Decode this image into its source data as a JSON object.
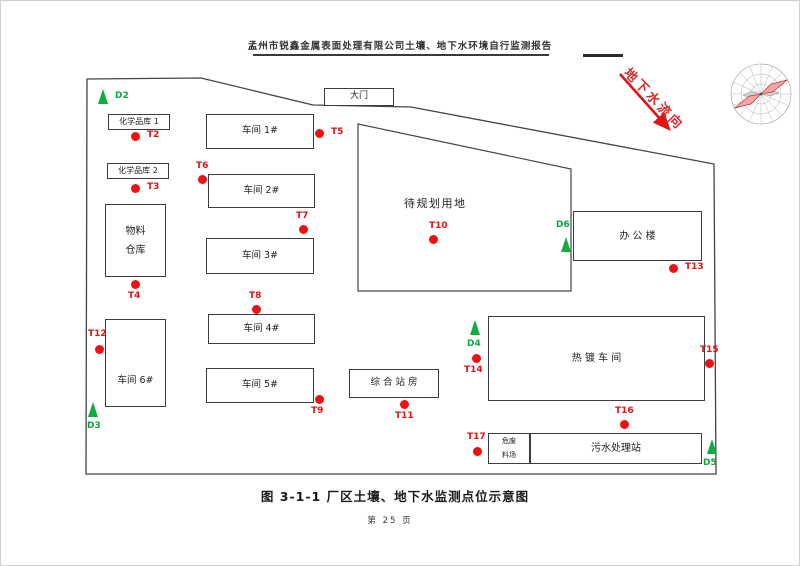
{
  "header": {
    "title": "孟州市锐鑫金属表面处理有限公司土壤、地下水环境自行监测报告"
  },
  "figure": {
    "caption": "图 3-1-1  厂区土壤、地下水监测点位示意图",
    "page_number": "第 25 页",
    "flow_arrow_label": "地下水流向"
  },
  "colors": {
    "point_red": "#ee1111",
    "label_red": "#e11212",
    "triangle_green": "#12ad3f",
    "label_green": "#0ca53e",
    "rose_pink": "#f2a6a6",
    "line_dark": "#3c3c3c"
  },
  "site": {
    "boundary_points": "86,78 200,77 312,104 410,106 713,163 715,473 85,473",
    "planned_area_points": "357,123 570,168 570,290 357,290",
    "planned_area_label": "待规划用地"
  },
  "buildings": [
    {
      "id": "chem-store-1",
      "label": "化学品库 1",
      "x": 107,
      "y": 113,
      "w": 62,
      "h": 16,
      "fs": 8
    },
    {
      "id": "chem-store-2",
      "label": "化学品库 2",
      "x": 106,
      "y": 162,
      "w": 62,
      "h": 16,
      "fs": 8
    },
    {
      "id": "material-warehouse",
      "label": "物料\n仓库",
      "x": 104,
      "y": 203,
      "w": 61,
      "h": 73,
      "fs": 10
    },
    {
      "id": "workshop-6",
      "label": "车间 6#",
      "x": 104,
      "y": 318,
      "w": 61,
      "h": 88,
      "fs": 9.5,
      "shift": 18
    },
    {
      "id": "workshop-1",
      "label": "车间 1#",
      "x": 205,
      "y": 113,
      "w": 108,
      "h": 35,
      "fs": 9.5
    },
    {
      "id": "workshop-2",
      "label": "车间 2#",
      "x": 207,
      "y": 173,
      "w": 107,
      "h": 34,
      "fs": 9.5
    },
    {
      "id": "workshop-3",
      "label": "车间 3#",
      "x": 205,
      "y": 237,
      "w": 108,
      "h": 36,
      "fs": 9.5
    },
    {
      "id": "workshop-4",
      "label": "车间 4#",
      "x": 207,
      "y": 313,
      "w": 107,
      "h": 30,
      "fs": 9.5
    },
    {
      "id": "workshop-5",
      "label": "车间 5#",
      "x": 205,
      "y": 367,
      "w": 108,
      "h": 35,
      "fs": 9.5
    },
    {
      "id": "main-gate",
      "label": "大门",
      "x": 323,
      "y": 87,
      "w": 70,
      "h": 18,
      "fs": 9
    },
    {
      "id": "composite-station",
      "label": "综 合 站 房",
      "x": 348,
      "y": 368,
      "w": 90,
      "h": 29,
      "fs": 9.5
    },
    {
      "id": "office-building",
      "label": "办 公 楼",
      "x": 572,
      "y": 210,
      "w": 129,
      "h": 50,
      "fs": 10
    },
    {
      "id": "galvanizing-workshop",
      "label": "热 镀 车 间",
      "x": 487,
      "y": 315,
      "w": 217,
      "h": 85,
      "fs": 10
    },
    {
      "id": "hazardous-waste-yard",
      "label": "危废\n料场",
      "x": 487,
      "y": 432,
      "w": 42,
      "h": 31,
      "fs": 7
    },
    {
      "id": "sewage-treatment-station",
      "label": "污水处理站",
      "x": 529,
      "y": 432,
      "w": 172,
      "h": 31,
      "fs": 10
    }
  ],
  "soil_points": [
    {
      "id": "T2",
      "x": 134,
      "y": 135,
      "lx": 146,
      "ly": 129
    },
    {
      "id": "T3",
      "x": 134,
      "y": 187,
      "lx": 146,
      "ly": 181
    },
    {
      "id": "T4",
      "x": 134,
      "y": 283,
      "lx": 127,
      "ly": 290
    },
    {
      "id": "T5",
      "x": 318,
      "y": 132,
      "lx": 330,
      "ly": 126
    },
    {
      "id": "T6",
      "x": 201,
      "y": 178,
      "lx": 195,
      "ly": 160
    },
    {
      "id": "T7",
      "x": 302,
      "y": 228,
      "lx": 295,
      "ly": 210
    },
    {
      "id": "T8",
      "x": 255,
      "y": 308,
      "lx": 248,
      "ly": 290
    },
    {
      "id": "T9",
      "x": 318,
      "y": 398,
      "lx": 310,
      "ly": 405
    },
    {
      "id": "T10",
      "x": 432,
      "y": 238,
      "lx": 428,
      "ly": 220
    },
    {
      "id": "T11",
      "x": 403,
      "y": 403,
      "lx": 394,
      "ly": 410
    },
    {
      "id": "T12",
      "x": 98,
      "y": 348,
      "lx": 87,
      "ly": 328
    },
    {
      "id": "T13",
      "x": 672,
      "y": 267,
      "lx": 684,
      "ly": 261
    },
    {
      "id": "T14",
      "x": 475,
      "y": 357,
      "lx": 463,
      "ly": 364
    },
    {
      "id": "T15",
      "x": 708,
      "y": 362,
      "lx": 699,
      "ly": 344
    },
    {
      "id": "T16",
      "x": 623,
      "y": 423,
      "lx": 614,
      "ly": 405
    },
    {
      "id": "T17",
      "x": 476,
      "y": 450,
      "lx": 466,
      "ly": 431
    }
  ],
  "gw_points": [
    {
      "id": "D2",
      "x": 102,
      "y": 96,
      "lx": 114,
      "ly": 90
    },
    {
      "id": "D3",
      "x": 92,
      "y": 409,
      "lx": 86,
      "ly": 420
    },
    {
      "id": "D4",
      "x": 474,
      "y": 327,
      "lx": 466,
      "ly": 338
    },
    {
      "id": "D5",
      "x": 711,
      "y": 446,
      "lx": 702,
      "ly": 457
    },
    {
      "id": "D6",
      "x": 565,
      "y": 244,
      "lx": 555,
      "ly": 219
    }
  ]
}
